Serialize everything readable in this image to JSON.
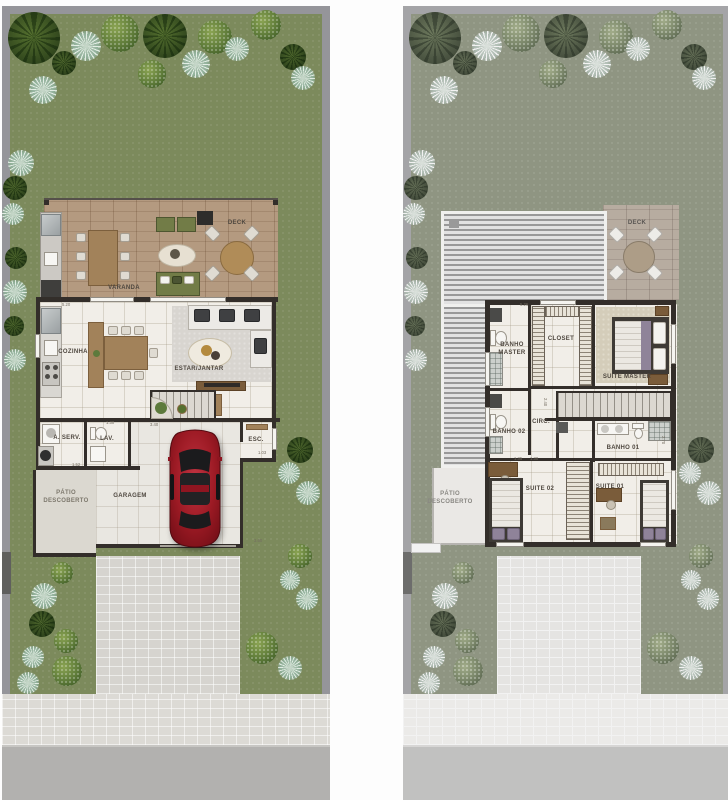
{
  "ground_floor": {
    "rooms": {
      "varanda": "VARANDA",
      "deck": "DECK",
      "cozinha": "COZINHA",
      "estar_jantar": "ESTAR/JANTAR",
      "a_serv": "A. SERV.",
      "lav": "LAV.",
      "esc": "ESC.",
      "garagem": "GARAGEM",
      "patio_descoberto": "PÁTIO DESCOBERTO"
    },
    "dims": {
      "d1": "5.20",
      "d2": "3.40",
      "d3": "1.30",
      "d4": "1.03",
      "d5": "3.60",
      "d6": "1.52"
    }
  },
  "upper_floor": {
    "rooms": {
      "deck": "DECK",
      "banho_master": "BANHO MASTER",
      "closet": "CLOSET",
      "suite_master": "SUITE MASTER",
      "banho_02": "BANHO 02",
      "circ": "CIRC.",
      "banho_01": "BANHO 01",
      "suite_02": "SUITE 02",
      "suite_01": "SUITE 01",
      "patio_descoberto": "PÁTIO DESCOBERTO"
    },
    "dims": {
      "d1": "5.26",
      "d2": "1.35",
      "d3": "1.30",
      "d4": "2.40",
      "d5": "2.70",
      "d6": "1.52"
    }
  },
  "colors": {
    "grass": "#7c8a5c",
    "grass_faded": "#bcc2a8",
    "wall": "#332e2a",
    "deck_wood": "#b49a80",
    "floor": "#f1eee8",
    "car_red": "#9c1a24",
    "street": "#b2b1af"
  }
}
